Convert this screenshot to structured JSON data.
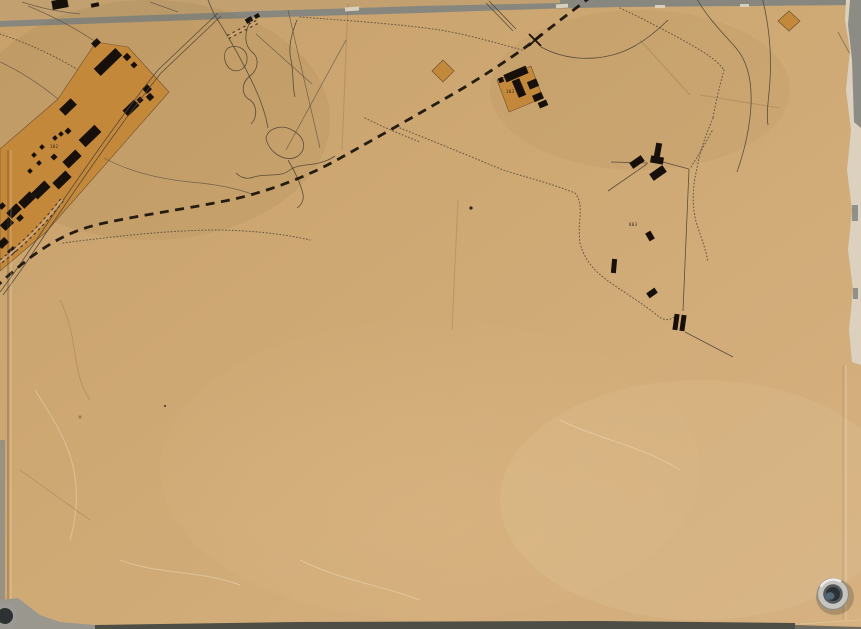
{
  "map": {
    "description": "photograph of a vintage hand-drawn survey map sheet on tan paper, fastened with a metal grommet",
    "labels": {
      "compound_number": "102",
      "depot_number": "103",
      "enclosure_number": "803"
    },
    "colors": {
      "background": "#87877f",
      "paper": "#cfa974",
      "paper_light": "#d8b484",
      "compound_fill": "#c4883b",
      "ink": "#17100a",
      "line": "#4e4336",
      "torn_edge": "#dbd1be",
      "dark_strip": "#4e4e46",
      "grommet_ring": "#c6c5c0",
      "grommet_hole": "#2b3034"
    },
    "features": {
      "railway": "bold dashed railway line",
      "barracks": "large orange barracks compound with black buildings",
      "depot": "small orange depot square with black buildings",
      "enclosure": "surveyed enclosure with scattered black buildings",
      "diamonds": "two small orange diamond markers",
      "grommet": "metal eyelet bottom-right"
    }
  }
}
